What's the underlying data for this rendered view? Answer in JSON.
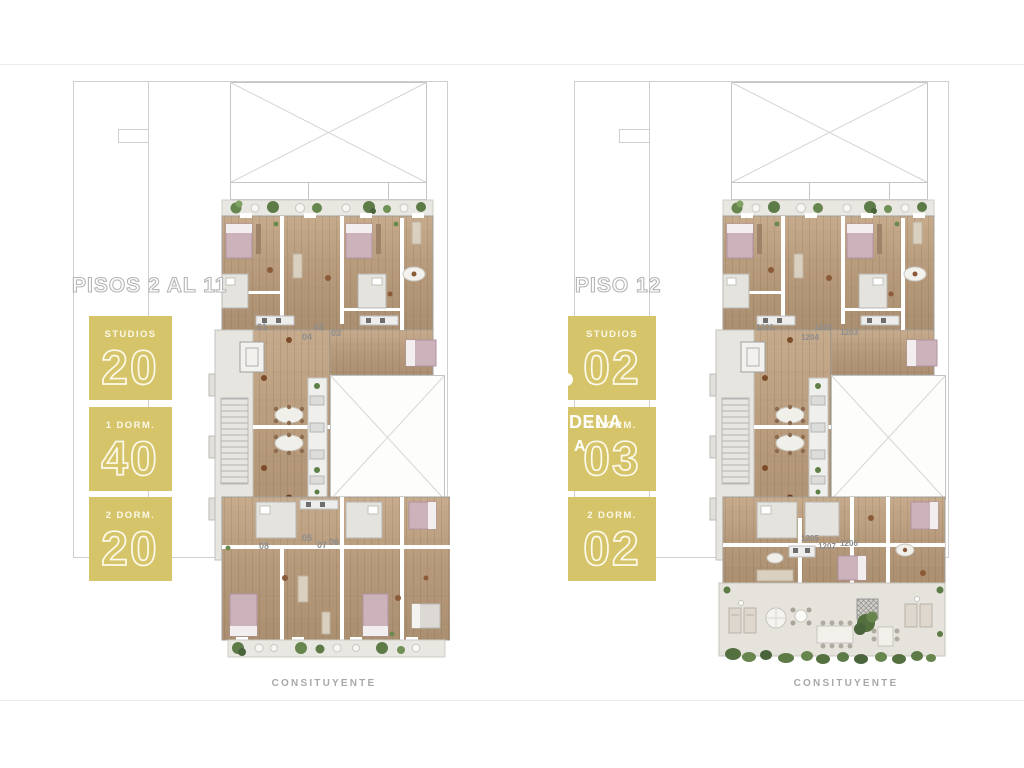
{
  "plans": {
    "left": {
      "title": "PISOS 2 AL 11",
      "street": "CONSITUYENTE",
      "stats": [
        {
          "label": "STUDIOS",
          "value": "20"
        },
        {
          "label": "1 DORM.",
          "value": "40"
        },
        {
          "label": "2 DORM.",
          "value": "20"
        }
      ],
      "units": {
        "u1": "01",
        "u2": "02",
        "u3": "03",
        "u4": "04",
        "u5": "05",
        "u6": "06",
        "u7": "07",
        "u8": "08"
      }
    },
    "right": {
      "title": "PISO 12",
      "street": "CONSITUYENTE",
      "stats": [
        {
          "label": "STUDIOS",
          "value": "02"
        },
        {
          "label": "1 DORM.",
          "value": "03"
        },
        {
          "label": "2 DORM.",
          "value": "02"
        }
      ],
      "units": {
        "u1201": "1201",
        "u1202": "1202",
        "u1203": "1203",
        "u1204": "1204",
        "u1205": "1205",
        "u1206": "1206",
        "u1207": "1207"
      }
    }
  },
  "watermark": {
    "line1": "DENA",
    "line2": "A"
  },
  "colors": {
    "accent_olive": "#d5c469",
    "stat_text": "#fbf8e9",
    "wood": "#b89a7c",
    "plan_outline": "#cfcfcf",
    "greenery": "#5d7b47",
    "label_gray": "#8d8d8d",
    "street_gray": "#a8a8a8"
  }
}
